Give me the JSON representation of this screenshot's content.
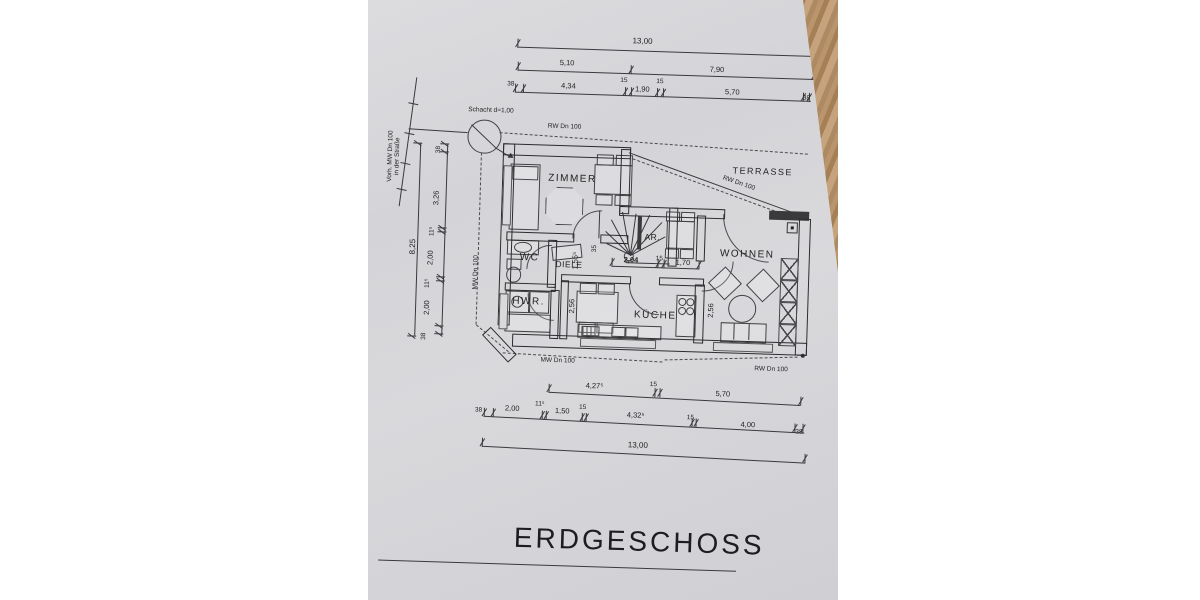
{
  "document": {
    "title": "ERDGESCHOSS"
  },
  "rooms": {
    "zimmer": "ZIMMER",
    "wc": "WC",
    "hwr": "HWR.",
    "diele": "DIELE",
    "ar": "AR.",
    "kueche": "KÜCHE",
    "wohnen": "WOHNEN",
    "terrasse": "TERRASSE"
  },
  "annotations": {
    "schacht": "Schacht d=1,00",
    "rw_top": "RW Dn 100",
    "rw_terrace": "RW Dn 100",
    "rw_bottom": "RW Dn 100",
    "mw_left": "MW Dn 100",
    "mw_bottom": "MW Dn 100",
    "street_line1": "Vorh. MW Dn 100",
    "street_line2": "in der Straße"
  },
  "dimensions": {
    "top_total": "13,00",
    "top_mid": [
      "5,10",
      "7,90"
    ],
    "top_detail": [
      "38",
      "4,34",
      "15",
      "1,90",
      "15",
      "5,70",
      "38"
    ],
    "left_total": "8,25",
    "left_detail": [
      "38",
      "3,26",
      "11⁵",
      "2,00",
      "11⁵",
      "2,00",
      "38"
    ],
    "bottom_mid": [
      "4,27⁵",
      "15",
      "5,70"
    ],
    "bottom_detail": [
      "38",
      "2,00",
      "11⁵",
      "1,50",
      "15",
      "4,32⁵",
      "15",
      "4,00",
      "38"
    ],
    "bottom_total": "13,00",
    "interior": {
      "kitchen_a": "2,04",
      "kitchen_b": "15",
      "kitchen_c": "1,70",
      "kitchen_depth_left": "2,56",
      "kitchen_depth_right": "2,56",
      "hall": "1,55⁵",
      "wall": "35"
    }
  }
}
